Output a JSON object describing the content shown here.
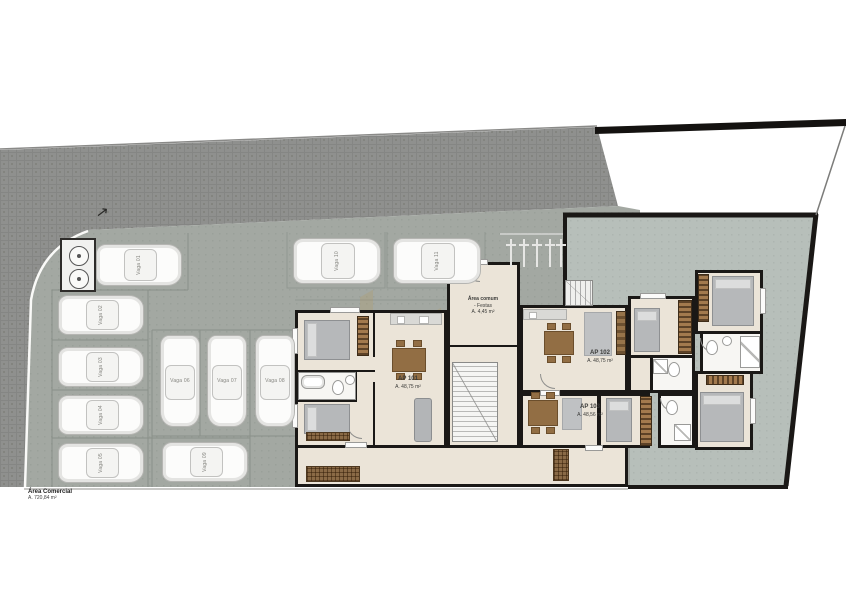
{
  "plan": {
    "commercial_area": {
      "title": "Área Comercial",
      "area": "A. 720,84 m²"
    },
    "common_area": {
      "name": "Área comum",
      "subname": "- Festas",
      "area": "A. 4,45 m²"
    },
    "apartments": [
      {
        "name": "AP 101",
        "area": "A. 48,75 m²"
      },
      {
        "name": "AP 102",
        "area": "A. 48,75 m²"
      },
      {
        "name": "AP 103",
        "area": "A. 48,56 m²"
      }
    ],
    "parking": {
      "spaces": [
        {
          "label": "Vaga 01"
        },
        {
          "label": "Vaga 02"
        },
        {
          "label": "Vaga 03"
        },
        {
          "label": "Vaga 04"
        },
        {
          "label": "Vaga 05"
        },
        {
          "label": "Vaga 06"
        },
        {
          "label": "Vaga 07"
        },
        {
          "label": "Vaga 08"
        },
        {
          "label": "Vaga 09"
        },
        {
          "label": "Vaga 10"
        },
        {
          "label": "Vaga 11"
        }
      ],
      "car_count": 11,
      "motorcycle_count": 5
    },
    "icons": {
      "entrance_arrow": "↗"
    },
    "colors": {
      "street": "#8f908e",
      "parking_lot": "#a3a8a2",
      "courtyard": "#b7bfba",
      "wall": "#1a1816",
      "floor": "#ebe4d8",
      "furniture_wood": "#8f6b41",
      "watermark": "#b9944d"
    }
  }
}
